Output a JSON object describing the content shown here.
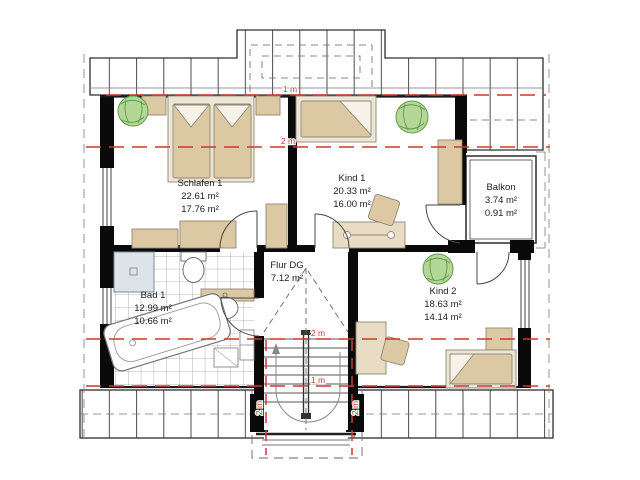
{
  "plan": {
    "rooms": {
      "schlafen1": {
        "name": "Schlafen 1",
        "area_total": "22.61 m²",
        "area_living": "17.76 m²"
      },
      "kind1": {
        "name": "Kind 1",
        "area_total": "20.33 m²",
        "area_living": "16.00 m²"
      },
      "kind2": {
        "name": "Kind 2",
        "area_total": "18.63 m²",
        "area_living": "14.14 m²"
      },
      "bad1": {
        "name": "Bad 1",
        "area_total": "12.99 m²",
        "area_living": "10.66 m²"
      },
      "flur": {
        "name": "Flur DG",
        "area_total": "7.12 m²"
      },
      "balkon": {
        "name": "Balkon",
        "area_total": "3.74 m²",
        "area_living": "0.91 m²"
      }
    },
    "height_labels": {
      "top_1m": "1 m",
      "top_2m": "2 m",
      "bottom_2m": "2 m",
      "bottom_1m": "1 m",
      "stair_left_2m": "2 m",
      "stair_right_2m": "2 m"
    },
    "colors": {
      "wall": "#0a0a0a",
      "red_height_line": "#c63c2f",
      "furniture_tan": "#dcc8a2",
      "furniture_light": "#ece5d8",
      "plant_green": "#b5d795",
      "shower_gray": "#dde4e9"
    }
  }
}
